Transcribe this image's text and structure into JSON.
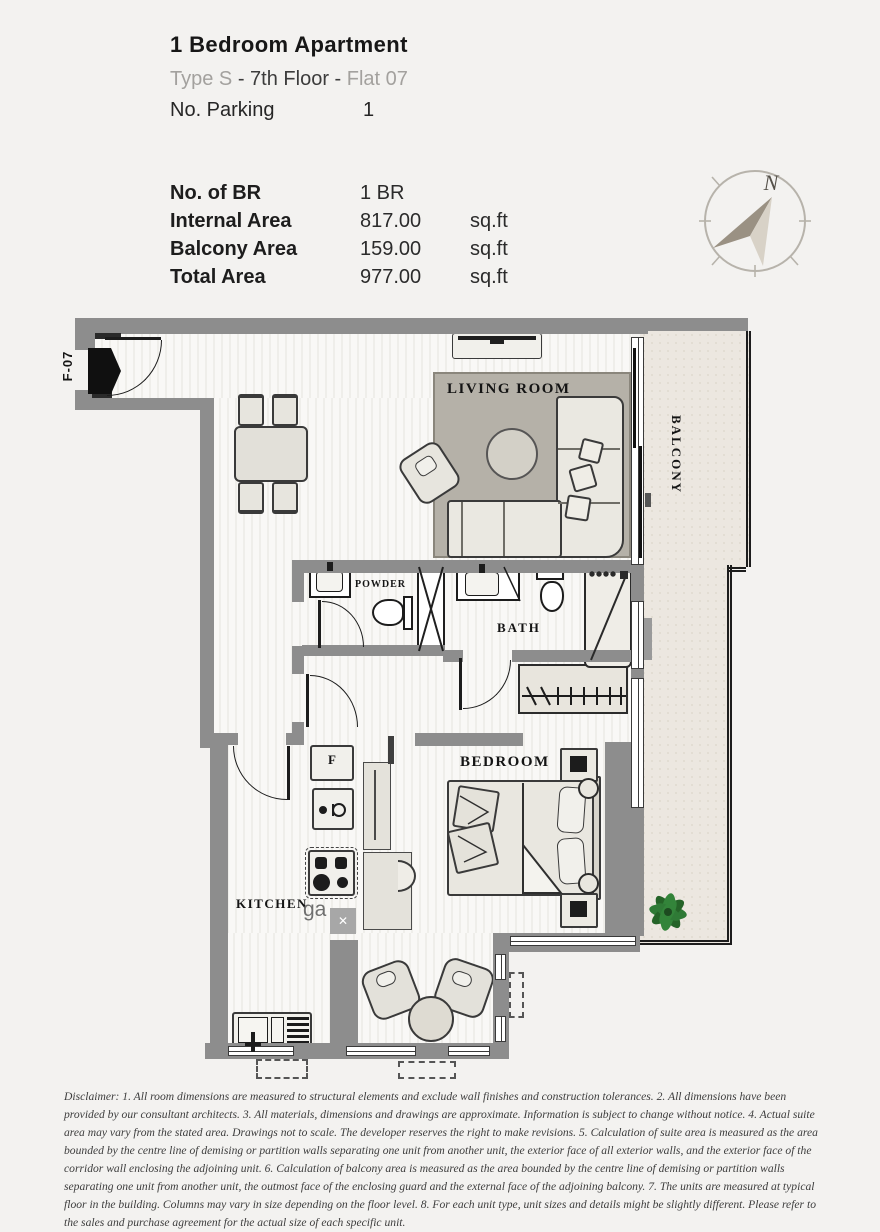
{
  "header": {
    "title": "1 Bedroom Apartment",
    "subtitle": {
      "type_label": "Type S",
      "sep1": " - ",
      "floor_label": "7th Floor",
      "sep2": " - ",
      "flat_label": "Flat 07"
    },
    "parking_label": "No. Parking",
    "parking_value": "1"
  },
  "specs": {
    "rows": [
      {
        "label": "No. of BR",
        "value": "1 BR",
        "unit": ""
      },
      {
        "label": "Internal Area",
        "value": "817.00",
        "unit": "sq.ft"
      },
      {
        "label": "Balcony Area",
        "value": "159.00",
        "unit": "sq.ft"
      },
      {
        "label": "Total Area",
        "value": "977.00",
        "unit": "sq.ft"
      }
    ]
  },
  "compass": {
    "north_label": "N"
  },
  "plan": {
    "unit_label": "F-07",
    "rooms": {
      "living": "LIVING ROOM",
      "balcony": "BALCONY",
      "powder": "POWDER",
      "bath": "BATH",
      "bedroom": "BEDROOM",
      "kitchen": "KITCHEN"
    },
    "fridge_label": "F",
    "watermark": "ga"
  },
  "colors": {
    "wall": "#8d8d8d",
    "balcony_floor": "#ece7e0",
    "rug": "#b5b1a8",
    "plant_green": "#2f7a36",
    "needle_dark": "#9a9183",
    "needle_light": "#d8d2c7"
  },
  "disclaimer": "Disclaimer: 1. All room dimensions are measured to structural elements and exclude wall finishes and construction tolerances. 2. All dimensions have been provided by our consultant architects. 3. All materials, dimensions and drawings are approximate. Information is subject to change without notice. 4. Actual suite area may vary from the stated area. Drawings not to scale. The developer reserves the right to make revisions. 5. Calculation of suite area is measured as the area bounded by the centre line of demising or partition walls separating one unit from another unit, the exterior face of all exterior walls, and the exterior face of the corridor wall enclosing the adjoining unit. 6. Calculation of balcony area is measured as the area bounded by the centre line of demising or partition walls separating one unit from another unit, the outmost face of the enclosing guard and the external face of the adjoining balcony. 7. The units are measured at typical floor in the building. Columns may vary in size depending on the floor level. 8. For each unit type, unit sizes and details might be slightly different. Please refer to the sales and purchase agreement for the actual size of each specific unit."
}
